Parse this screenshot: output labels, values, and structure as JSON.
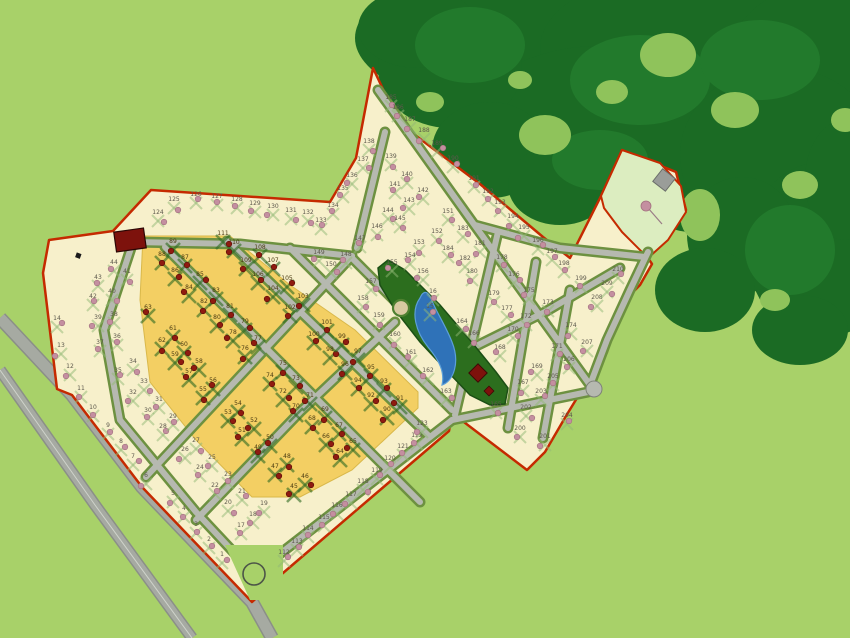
{
  "map": {
    "type": "residential-subdivision-master-plan",
    "palette": {
      "background_green": "#a8d169",
      "forest_dark": "#1b6b24",
      "forest_mid": "#227a2c",
      "forest_hole": "#8fc35b",
      "parcel_cream": "#f7f0cb",
      "parcel_yellow": "#f3cf63",
      "boundary_red": "#c52a00",
      "road_gray": "#b6b9b0",
      "road_edge": "#7e8278",
      "verge_olive": "#6d9140",
      "park_dark_green": "#2c6e1e",
      "ne_park_pale_green": "#dcedc0",
      "pond_blue": "#2f72b8",
      "pond_light": "#6aa4d8",
      "tree_pink": "#c48fa0",
      "tree_dark_red": "#8f1b10",
      "building_dark_red": "#7d120c",
      "building_gray": "#9a9d99",
      "label_cream_lot": "#5c584c",
      "label_yellow_lot": "#4a3b12"
    },
    "features": [
      "forest-icon",
      "pond-icon",
      "central-park",
      "ne-park",
      "roundabout-icon",
      "clubhouse-building-icon",
      "entrance-building-icon",
      "park-square-building-icon",
      "park-plaza-circle",
      "highway-road",
      "perimeter-boundary",
      "street-network",
      "pink-tree-icon",
      "red-tree-icon"
    ],
    "lots": [
      [
        1,
        222,
        556,
        "c"
      ],
      [
        2,
        209,
        541,
        "c"
      ],
      [
        3,
        196,
        526,
        "c"
      ],
      [
        4,
        184,
        510,
        "c"
      ],
      [
        5,
        173,
        495,
        "c"
      ],
      [
        6,
        146,
        477,
        "c"
      ],
      [
        7,
        133,
        458,
        "c"
      ],
      [
        8,
        121,
        443,
        "c"
      ],
      [
        9,
        108,
        427,
        "c"
      ],
      [
        10,
        93,
        409,
        "c"
      ],
      [
        11,
        81,
        390,
        "c"
      ],
      [
        12,
        70,
        368,
        "c"
      ],
      [
        13,
        61,
        347,
        "c"
      ],
      [
        14,
        57,
        320,
        "c"
      ],
      [
        15,
        430,
        308,
        "c"
      ],
      [
        16,
        433,
        293,
        "c"
      ],
      [
        17,
        241,
        527,
        "c"
      ],
      [
        18,
        253,
        516,
        "c"
      ],
      [
        19,
        264,
        505,
        "c"
      ],
      [
        20,
        228,
        504,
        "c"
      ],
      [
        21,
        242,
        493,
        "c"
      ],
      [
        22,
        215,
        487,
        "c"
      ],
      [
        23,
        228,
        476,
        "c"
      ],
      [
        24,
        200,
        469,
        "c"
      ],
      [
        25,
        212,
        459,
        "c"
      ],
      [
        26,
        185,
        451,
        "c"
      ],
      [
        27,
        196,
        442,
        "c"
      ],
      [
        28,
        163,
        428,
        "c"
      ],
      [
        29,
        173,
        418,
        "c"
      ],
      [
        30,
        148,
        412,
        "c"
      ],
      [
        31,
        159,
        401,
        "c"
      ],
      [
        32,
        133,
        394,
        "c"
      ],
      [
        33,
        144,
        383,
        "c"
      ],
      [
        34,
        133,
        363,
        "c"
      ],
      [
        35,
        118,
        372,
        "c"
      ],
      [
        36,
        117,
        338,
        "c"
      ],
      [
        37,
        100,
        344,
        "c"
      ],
      [
        38,
        114,
        316,
        "c"
      ],
      [
        39,
        98,
        319,
        "c"
      ],
      [
        40,
        112,
        293,
        "c"
      ],
      [
        41,
        127,
        273,
        "c"
      ],
      [
        42,
        93,
        298,
        "c"
      ],
      [
        43,
        98,
        279,
        "c"
      ],
      [
        44,
        114,
        264,
        "c"
      ],
      [
        45,
        294,
        488,
        "y"
      ],
      [
        46,
        305,
        478,
        "y"
      ],
      [
        47,
        275,
        468,
        "y"
      ],
      [
        48,
        287,
        458,
        "y"
      ],
      [
        49,
        258,
        449,
        "y"
      ],
      [
        50,
        270,
        439,
        "y"
      ],
      [
        51,
        242,
        432,
        "y"
      ],
      [
        52,
        254,
        422,
        "y"
      ],
      [
        53,
        228,
        414,
        "y"
      ],
      [
        54,
        238,
        405,
        "y"
      ],
      [
        55,
        203,
        391,
        "y"
      ],
      [
        56,
        213,
        382,
        "y"
      ],
      [
        57,
        189,
        373,
        "y"
      ],
      [
        58,
        199,
        363,
        "y"
      ],
      [
        59,
        175,
        356,
        "y"
      ],
      [
        60,
        184,
        346,
        "y"
      ],
      [
        61,
        173,
        330,
        "y"
      ],
      [
        62,
        162,
        342,
        "y"
      ],
      [
        63,
        148,
        309,
        "y"
      ],
      [
        64,
        340,
        453,
        "y"
      ],
      [
        65,
        353,
        443,
        "y"
      ],
      [
        66,
        326,
        438,
        "y"
      ],
      [
        67,
        339,
        427,
        "y"
      ],
      [
        68,
        312,
        420,
        "y"
      ],
      [
        69,
        325,
        411,
        "y"
      ],
      [
        70,
        296,
        408,
        "y"
      ],
      [
        71,
        310,
        397,
        "y"
      ],
      [
        72,
        283,
        393,
        "y"
      ],
      [
        73,
        296,
        380,
        "y"
      ],
      [
        74,
        270,
        377,
        "y"
      ],
      [
        75,
        283,
        365,
        "y"
      ],
      [
        76,
        245,
        350,
        "y"
      ],
      [
        77,
        258,
        340,
        "y"
      ],
      [
        78,
        233,
        334,
        "y"
      ],
      [
        79,
        245,
        323,
        "y"
      ],
      [
        80,
        217,
        319,
        "y"
      ],
      [
        81,
        230,
        308,
        "y"
      ],
      [
        82,
        204,
        303,
        "y"
      ],
      [
        83,
        216,
        292,
        "y"
      ],
      [
        84,
        189,
        289,
        "y"
      ],
      [
        85,
        200,
        276,
        "y"
      ],
      [
        86,
        175,
        272,
        "y"
      ],
      [
        87,
        185,
        259,
        "y"
      ],
      [
        88,
        162,
        256,
        "y"
      ],
      [
        89,
        173,
        243,
        "y"
      ],
      [
        90,
        387,
        411,
        "y"
      ],
      [
        91,
        400,
        400,
        "y"
      ],
      [
        92,
        371,
        397,
        "y"
      ],
      [
        93,
        384,
        383,
        "y"
      ],
      [
        94,
        358,
        382,
        "y"
      ],
      [
        95,
        371,
        369,
        "y"
      ],
      [
        96,
        345,
        366,
        "y"
      ],
      [
        97,
        358,
        353,
        "y"
      ],
      [
        98,
        330,
        351,
        "y"
      ],
      [
        99,
        342,
        338,
        "y"
      ],
      [
        100,
        314,
        336,
        "y"
      ],
      [
        101,
        327,
        324,
        "y"
      ],
      [
        102,
        290,
        309,
        "y"
      ],
      [
        103,
        303,
        298,
        "y"
      ],
      [
        104,
        273,
        290,
        "y"
      ],
      [
        105,
        287,
        280,
        "y"
      ],
      [
        106,
        258,
        276,
        "y"
      ],
      [
        107,
        273,
        262,
        "y"
      ],
      [
        108,
        260,
        249,
        "y"
      ],
      [
        109,
        246,
        262,
        "y"
      ],
      [
        110,
        234,
        244,
        "y"
      ],
      [
        111,
        223,
        235,
        "y"
      ],
      [
        112,
        284,
        554,
        "c"
      ],
      [
        113,
        297,
        543,
        "c"
      ],
      [
        114,
        308,
        530,
        "c"
      ],
      [
        115,
        324,
        519,
        "c"
      ],
      [
        116,
        337,
        507,
        "c"
      ],
      [
        117,
        351,
        496,
        "c"
      ],
      [
        118,
        363,
        483,
        "c"
      ],
      [
        119,
        377,
        472,
        "c"
      ],
      [
        120,
        390,
        460,
        "c"
      ],
      [
        121,
        403,
        448,
        "c"
      ],
      [
        122,
        417,
        437,
        "c"
      ],
      [
        123,
        422,
        425,
        "c"
      ],
      [
        124,
        158,
        214,
        "c"
      ],
      [
        125,
        174,
        201,
        "c"
      ],
      [
        126,
        196,
        196,
        "c"
      ],
      [
        127,
        217,
        198,
        "c"
      ],
      [
        128,
        237,
        201,
        "c"
      ],
      [
        129,
        255,
        205,
        "c"
      ],
      [
        130,
        273,
        208,
        "c"
      ],
      [
        131,
        291,
        212,
        "c"
      ],
      [
        132,
        308,
        214,
        "c"
      ],
      [
        133,
        321,
        222,
        "c"
      ],
      [
        134,
        333,
        207,
        "c"
      ],
      [
        135,
        343,
        190,
        "c"
      ],
      [
        136,
        352,
        177,
        "c"
      ],
      [
        137,
        363,
        161,
        "c"
      ],
      [
        138,
        369,
        143,
        "c"
      ],
      [
        139,
        391,
        158,
        "c"
      ],
      [
        140,
        407,
        176,
        "c"
      ],
      [
        141,
        395,
        186,
        "c"
      ],
      [
        142,
        423,
        192,
        "c"
      ],
      [
        143,
        409,
        202,
        "c"
      ],
      [
        144,
        388,
        212,
        "c"
      ],
      [
        145,
        400,
        220,
        "c"
      ],
      [
        146,
        377,
        228,
        "c"
      ],
      [
        147,
        360,
        240,
        "c"
      ],
      [
        148,
        346,
        256,
        "c"
      ],
      [
        149,
        319,
        254,
        "c"
      ],
      [
        150,
        331,
        266,
        "c"
      ],
      [
        151,
        448,
        213,
        "c"
      ],
      [
        152,
        437,
        233,
        "c"
      ],
      [
        153,
        419,
        244,
        "c"
      ],
      [
        154,
        410,
        257,
        "c"
      ],
      [
        155,
        392,
        264,
        "c"
      ],
      [
        156,
        423,
        273,
        "c"
      ],
      [
        157,
        371,
        283,
        "c"
      ],
      [
        158,
        363,
        300,
        "c"
      ],
      [
        159,
        379,
        317,
        "c"
      ],
      [
        160,
        395,
        336,
        "c"
      ],
      [
        161,
        411,
        354,
        "c"
      ],
      [
        162,
        428,
        372,
        "c"
      ],
      [
        163,
        446,
        393,
        "c"
      ],
      [
        164,
        462,
        323,
        "c"
      ],
      [
        165,
        496,
        406,
        "c"
      ],
      [
        166,
        474,
        335,
        "c"
      ],
      [
        167,
        523,
        384,
        "c"
      ],
      [
        168,
        500,
        349,
        "c"
      ],
      [
        169,
        537,
        368,
        "c"
      ],
      [
        170,
        513,
        331,
        "c"
      ],
      [
        171,
        557,
        348,
        "c"
      ],
      [
        172,
        526,
        318,
        "c"
      ],
      [
        173,
        548,
        304,
        "c"
      ],
      [
        174,
        571,
        327,
        "c"
      ],
      [
        175,
        529,
        292,
        "c"
      ],
      [
        176,
        514,
        276,
        "c"
      ],
      [
        177,
        507,
        310,
        "c"
      ],
      [
        178,
        502,
        259,
        "c"
      ],
      [
        179,
        494,
        295,
        "c"
      ],
      [
        180,
        472,
        273,
        "c"
      ],
      [
        181,
        480,
        245,
        "c"
      ],
      [
        182,
        465,
        260,
        "c"
      ],
      [
        183,
        463,
        230,
        "c"
      ],
      [
        184,
        448,
        250,
        "c"
      ],
      [
        185,
        391,
        99,
        "c"
      ],
      [
        186,
        398,
        109,
        "c"
      ],
      [
        187,
        410,
        121,
        "c"
      ],
      [
        188,
        424,
        132,
        "c"
      ],
      [
        189,
        437,
        145,
        "c"
      ],
      [
        190,
        453,
        160,
        "c"
      ],
      [
        191,
        474,
        180,
        "c"
      ],
      [
        192,
        488,
        193,
        "c"
      ],
      [
        193,
        500,
        204,
        "c"
      ],
      [
        194,
        513,
        218,
        "c"
      ],
      [
        195,
        524,
        229,
        "c"
      ],
      [
        196,
        538,
        242,
        "c"
      ],
      [
        197,
        552,
        253,
        "c"
      ],
      [
        198,
        564,
        265,
        "c"
      ],
      [
        199,
        581,
        280,
        "c"
      ],
      [
        200,
        520,
        430,
        "c"
      ],
      [
        201,
        545,
        438,
        "c"
      ],
      [
        202,
        526,
        409,
        "c"
      ],
      [
        203,
        541,
        393,
        "c"
      ],
      [
        204,
        567,
        417,
        "c"
      ],
      [
        205,
        553,
        378,
        "c"
      ],
      [
        206,
        569,
        361,
        "c"
      ],
      [
        207,
        587,
        344,
        "c"
      ],
      [
        208,
        597,
        299,
        "c"
      ],
      [
        209,
        607,
        285,
        "c"
      ],
      [
        210,
        618,
        271,
        "c"
      ]
    ]
  }
}
